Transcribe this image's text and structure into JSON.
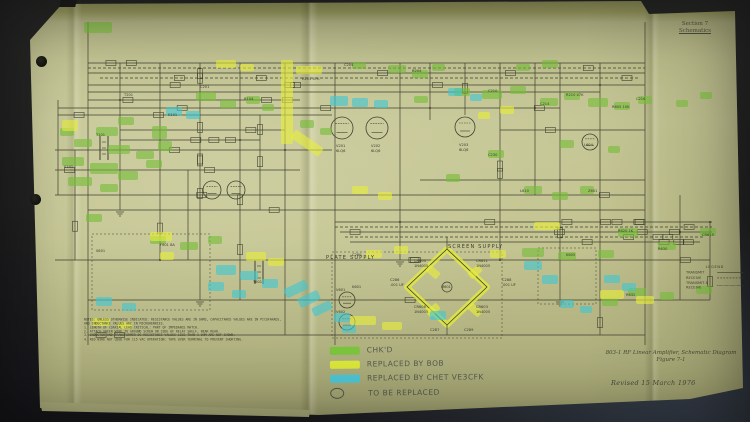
{
  "document": {
    "corner_label": {
      "line1": "Section 7",
      "line2": "Schematics"
    },
    "section_labels": [
      {
        "text": "PLATE SUPPLY",
        "x": 326,
        "y": 259
      },
      {
        "text": "SCREEN SUPPLY",
        "x": 448,
        "y": 248
      }
    ],
    "legend_box": {
      "title": "LEGEND",
      "entries": [
        {
          "label": "TRANSMIT",
          "style": "solid"
        },
        {
          "label": "RECEIVE",
          "style": "dashed"
        },
        {
          "label": "TRANSMIT & RECEIVE",
          "style": "dashdot"
        }
      ]
    },
    "notes": [
      "NOTES: UNLESS OTHERWISE INDICATED: RESISTANCE VALUES ARE IN OHMS, CAPACITANCE VALUES ARE IN PICOFARADS,",
      "AND INDUCTANCE VALUES ARE IN MICROHENRIES.",
      "1. LENGTH OF COAXIAL LEAD CRITICAL: PART OF IMPEDANCE MATCH.",
      "2. ATTACH GREEN WIRE TO GROUND SCREW ON SIDE OF RELAY SHELF, NEAR REAR.",
      "3. INDUCTOR AND TRANSFORMER DC RESISTANCE VALUES LESS THAN 1 OHM ARE NOT SHOWN.",
      "4. RED WIRE NOT USED FOR 115 VAC OPERATION: TAPE OVER TERMINAL TO PREVENT SHORTING."
    ],
    "marker_key": {
      "items": [
        {
          "swatch": "green",
          "text": "CHK'D"
        },
        {
          "swatch": "yellow",
          "text": "REPLACED BY BOB"
        },
        {
          "swatch": "blue",
          "text": "REPLACED BY CHET VE3CFK"
        },
        {
          "swatch": "circle",
          "text": "TO BE REPLACED"
        }
      ]
    },
    "caption": {
      "line1": "803-1 RF Linear Amplifier, Schematic Diagram",
      "line2": "Figure 7-1"
    },
    "revision": "Revised 15 March 1976"
  },
  "schematic": {
    "ink_color": "#3f4130",
    "highlight_colors": {
      "g": "#76bd38",
      "y": "#e6ee3a",
      "b": "#3fc6d2"
    },
    "highlights": [
      [
        "g",
        84,
        22,
        28,
        11,
        0
      ],
      [
        "g",
        196,
        92,
        20,
        9,
        0
      ],
      [
        "g",
        220,
        100,
        16,
        8,
        0
      ],
      [
        "g",
        246,
        96,
        14,
        8,
        0
      ],
      [
        "g",
        262,
        104,
        12,
        7,
        0
      ],
      [
        "g",
        118,
        117,
        16,
        8,
        0
      ],
      [
        "g",
        96,
        127,
        22,
        9,
        0
      ],
      [
        "g",
        74,
        139,
        18,
        8,
        0
      ],
      [
        "g",
        108,
        145,
        22,
        9,
        0
      ],
      [
        "g",
        136,
        151,
        18,
        8,
        0
      ],
      [
        "g",
        62,
        157,
        22,
        9,
        0
      ],
      [
        "g",
        90,
        163,
        28,
        11,
        0
      ],
      [
        "g",
        118,
        171,
        20,
        9,
        0
      ],
      [
        "g",
        146,
        160,
        16,
        8,
        0
      ],
      [
        "g",
        68,
        177,
        24,
        9,
        0
      ],
      [
        "g",
        100,
        184,
        18,
        8,
        0
      ],
      [
        "g",
        152,
        126,
        15,
        13,
        0
      ],
      [
        "g",
        158,
        141,
        14,
        10,
        0
      ],
      [
        "g",
        352,
        62,
        14,
        7,
        0
      ],
      [
        "g",
        388,
        65,
        18,
        8,
        0
      ],
      [
        "g",
        412,
        70,
        16,
        8,
        0
      ],
      [
        "g",
        432,
        64,
        13,
        7,
        0
      ],
      [
        "g",
        454,
        88,
        16,
        8,
        0
      ],
      [
        "g",
        482,
        90,
        20,
        9,
        0
      ],
      [
        "g",
        510,
        86,
        16,
        8,
        0
      ],
      [
        "g",
        540,
        98,
        18,
        8,
        0
      ],
      [
        "g",
        564,
        92,
        16,
        8,
        0
      ],
      [
        "g",
        588,
        98,
        20,
        9,
        0
      ],
      [
        "g",
        614,
        102,
        16,
        8,
        0
      ],
      [
        "g",
        638,
        96,
        14,
        8,
        0
      ],
      [
        "g",
        516,
        64,
        14,
        7,
        0
      ],
      [
        "g",
        542,
        60,
        16,
        8,
        0
      ],
      [
        "g",
        488,
        150,
        16,
        8,
        0
      ],
      [
        "g",
        446,
        174,
        14,
        8,
        0
      ],
      [
        "g",
        524,
        186,
        18,
        8,
        0
      ],
      [
        "g",
        552,
        192,
        16,
        8,
        0
      ],
      [
        "g",
        580,
        186,
        14,
        8,
        0
      ],
      [
        "g",
        618,
        228,
        20,
        9,
        0
      ],
      [
        "g",
        658,
        242,
        18,
        8,
        0
      ],
      [
        "g",
        700,
        228,
        16,
        8,
        0
      ],
      [
        "g",
        522,
        248,
        22,
        9,
        0
      ],
      [
        "g",
        558,
        252,
        18,
        8,
        0
      ],
      [
        "g",
        598,
        250,
        16,
        8,
        0
      ],
      [
        "g",
        628,
        288,
        18,
        8,
        0
      ],
      [
        "g",
        602,
        298,
        16,
        8,
        0
      ],
      [
        "g",
        660,
        292,
        14,
        8,
        0
      ],
      [
        "g",
        696,
        286,
        16,
        8,
        0
      ],
      [
        "g",
        150,
        236,
        16,
        8,
        0
      ],
      [
        "g",
        180,
        242,
        18,
        8,
        0
      ],
      [
        "g",
        208,
        236,
        14,
        8,
        0
      ],
      [
        "g",
        86,
        214,
        16,
        8,
        0
      ],
      [
        "g",
        60,
        128,
        14,
        8,
        0
      ],
      [
        "g",
        414,
        96,
        14,
        7,
        0
      ],
      [
        "g",
        300,
        120,
        14,
        8,
        0
      ],
      [
        "g",
        320,
        128,
        12,
        7,
        0
      ],
      [
        "g",
        560,
        140,
        14,
        8,
        0
      ],
      [
        "g",
        608,
        146,
        12,
        7,
        0
      ],
      [
        "g",
        676,
        100,
        12,
        7,
        0
      ],
      [
        "g",
        700,
        92,
        12,
        7,
        0
      ],
      [
        "y",
        281,
        60,
        12,
        84,
        0
      ],
      [
        "y",
        296,
        66,
        26,
        8,
        0
      ],
      [
        "y",
        290,
        138,
        34,
        10,
        35
      ],
      [
        "y",
        62,
        120,
        16,
        11,
        0
      ],
      [
        "y",
        150,
        232,
        22,
        9,
        0
      ],
      [
        "y",
        246,
        252,
        20,
        9,
        0
      ],
      [
        "y",
        268,
        258,
        16,
        8,
        0
      ],
      [
        "y",
        366,
        250,
        16,
        8,
        0
      ],
      [
        "y",
        394,
        246,
        14,
        8,
        0
      ],
      [
        "y",
        490,
        250,
        16,
        8,
        0
      ],
      [
        "y",
        350,
        316,
        26,
        9,
        0
      ],
      [
        "y",
        382,
        322,
        20,
        8,
        0
      ],
      [
        "y",
        600,
        290,
        24,
        9,
        0
      ],
      [
        "y",
        636,
        296,
        18,
        8,
        0
      ],
      [
        "y",
        92,
        318,
        18,
        8,
        0
      ],
      [
        "y",
        118,
        322,
        14,
        7,
        0
      ],
      [
        "y",
        160,
        252,
        14,
        8,
        0
      ],
      [
        "y",
        534,
        222,
        26,
        8,
        0
      ],
      [
        "y",
        216,
        60,
        20,
        8,
        0
      ],
      [
        "y",
        240,
        64,
        14,
        7,
        0
      ],
      [
        "y",
        426,
        268,
        14,
        8,
        40
      ],
      [
        "y",
        468,
        268,
        14,
        8,
        -40
      ],
      [
        "y",
        426,
        306,
        14,
        8,
        -40
      ],
      [
        "y",
        468,
        306,
        14,
        8,
        40
      ],
      [
        "y",
        500,
        106,
        14,
        8,
        0
      ],
      [
        "y",
        478,
        112,
        12,
        7,
        0
      ],
      [
        "y",
        352,
        186,
        16,
        8,
        0
      ],
      [
        "y",
        378,
        192,
        14,
        8,
        0
      ],
      [
        "b",
        330,
        96,
        18,
        10,
        0
      ],
      [
        "b",
        352,
        98,
        16,
        9,
        0
      ],
      [
        "b",
        374,
        100,
        14,
        8,
        0
      ],
      [
        "b",
        166,
        107,
        16,
        9,
        0
      ],
      [
        "b",
        186,
        111,
        14,
        8,
        0
      ],
      [
        "b",
        216,
        265,
        20,
        10,
        0
      ],
      [
        "b",
        240,
        271,
        18,
        9,
        0
      ],
      [
        "b",
        262,
        279,
        16,
        9,
        0
      ],
      [
        "b",
        284,
        284,
        24,
        10,
        -25
      ],
      [
        "b",
        298,
        294,
        22,
        10,
        -25
      ],
      [
        "b",
        312,
        304,
        20,
        9,
        -25
      ],
      [
        "b",
        334,
        313,
        16,
        9,
        0
      ],
      [
        "b",
        342,
        325,
        14,
        8,
        0
      ],
      [
        "b",
        430,
        311,
        16,
        9,
        0
      ],
      [
        "b",
        524,
        261,
        18,
        9,
        0
      ],
      [
        "b",
        542,
        275,
        16,
        9,
        0
      ],
      [
        "b",
        604,
        275,
        16,
        8,
        0
      ],
      [
        "b",
        622,
        283,
        14,
        8,
        0
      ],
      [
        "b",
        96,
        297,
        16,
        9,
        0
      ],
      [
        "b",
        122,
        303,
        14,
        8,
        0
      ],
      [
        "b",
        448,
        88,
        14,
        8,
        0
      ],
      [
        "b",
        470,
        94,
        12,
        7,
        0
      ],
      [
        "b",
        560,
        300,
        14,
        8,
        0
      ],
      [
        "b",
        580,
        306,
        12,
        7,
        0
      ],
      [
        "b",
        208,
        282,
        16,
        9,
        0
      ],
      [
        "b",
        232,
        290,
        14,
        8,
        0
      ]
    ],
    "tubes": [
      [
        342,
        128,
        11
      ],
      [
        377,
        128,
        11
      ],
      [
        465,
        127,
        10
      ],
      [
        212,
        190,
        9
      ],
      [
        236,
        190,
        9
      ],
      [
        347,
        300,
        8
      ],
      [
        347,
        322,
        8
      ],
      [
        590,
        142,
        8
      ]
    ],
    "component_labels": [
      [
        "V201",
        336,
        147
      ],
      [
        "6LQ6",
        336,
        152
      ],
      [
        "V202",
        371,
        147
      ],
      [
        "6LQ6",
        371,
        152
      ],
      [
        "V203",
        459,
        146
      ],
      [
        "6LQ6",
        459,
        151
      ],
      [
        "CR604",
        414,
        262
      ],
      [
        "1N4005",
        414,
        267
      ],
      [
        "CR611",
        476,
        262
      ],
      [
        "1N4005",
        476,
        267
      ],
      [
        "CR608",
        414,
        308
      ],
      [
        "1N4005",
        414,
        313
      ],
      [
        "CR603",
        476,
        308
      ],
      [
        "1N4005",
        476,
        313
      ],
      [
        "C286",
        390,
        281
      ],
      [
        ".001 UF",
        390,
        286
      ],
      [
        "C288",
        502,
        281
      ],
      [
        ".001 UF",
        502,
        286
      ],
      [
        "C287",
        430,
        331
      ],
      [
        "C289",
        464,
        331
      ],
      [
        "M601",
        441,
        288
      ],
      [
        "T601",
        253,
        283
      ],
      [
        "K601",
        352,
        288
      ],
      [
        "F601 8A",
        160,
        246
      ],
      [
        "S601",
        96,
        252
      ],
      [
        "V601",
        336,
        291
      ],
      [
        "V602",
        336,
        313
      ],
      [
        "L604",
        584,
        146
      ],
      [
        "R605 10K",
        612,
        108
      ],
      [
        "C214",
        540,
        105
      ],
      [
        "R201 47K",
        302,
        80
      ],
      [
        "C201",
        200,
        88
      ],
      [
        "T201",
        124,
        96
      ],
      [
        "K605",
        566,
        256
      ],
      [
        "R630",
        658,
        250
      ],
      [
        "CR615",
        702,
        236
      ],
      [
        "T101",
        96,
        136
      ],
      [
        "S101",
        64,
        168
      ],
      [
        "R632",
        626,
        296
      ],
      [
        "C280",
        352,
        256
      ],
      [
        "Z601",
        588,
        192
      ],
      [
        "L610",
        520,
        192
      ],
      [
        "C230",
        488,
        156
      ],
      [
        "R620 1K",
        618,
        232
      ],
      [
        "K101",
        168,
        116
      ],
      [
        "C204",
        344,
        66
      ],
      [
        "R204",
        412,
        72
      ],
      [
        "C210",
        488,
        92
      ],
      [
        "R210 47K",
        566,
        96
      ],
      [
        "C216",
        636,
        100
      ],
      [
        "R104",
        244,
        100
      ]
    ]
  }
}
